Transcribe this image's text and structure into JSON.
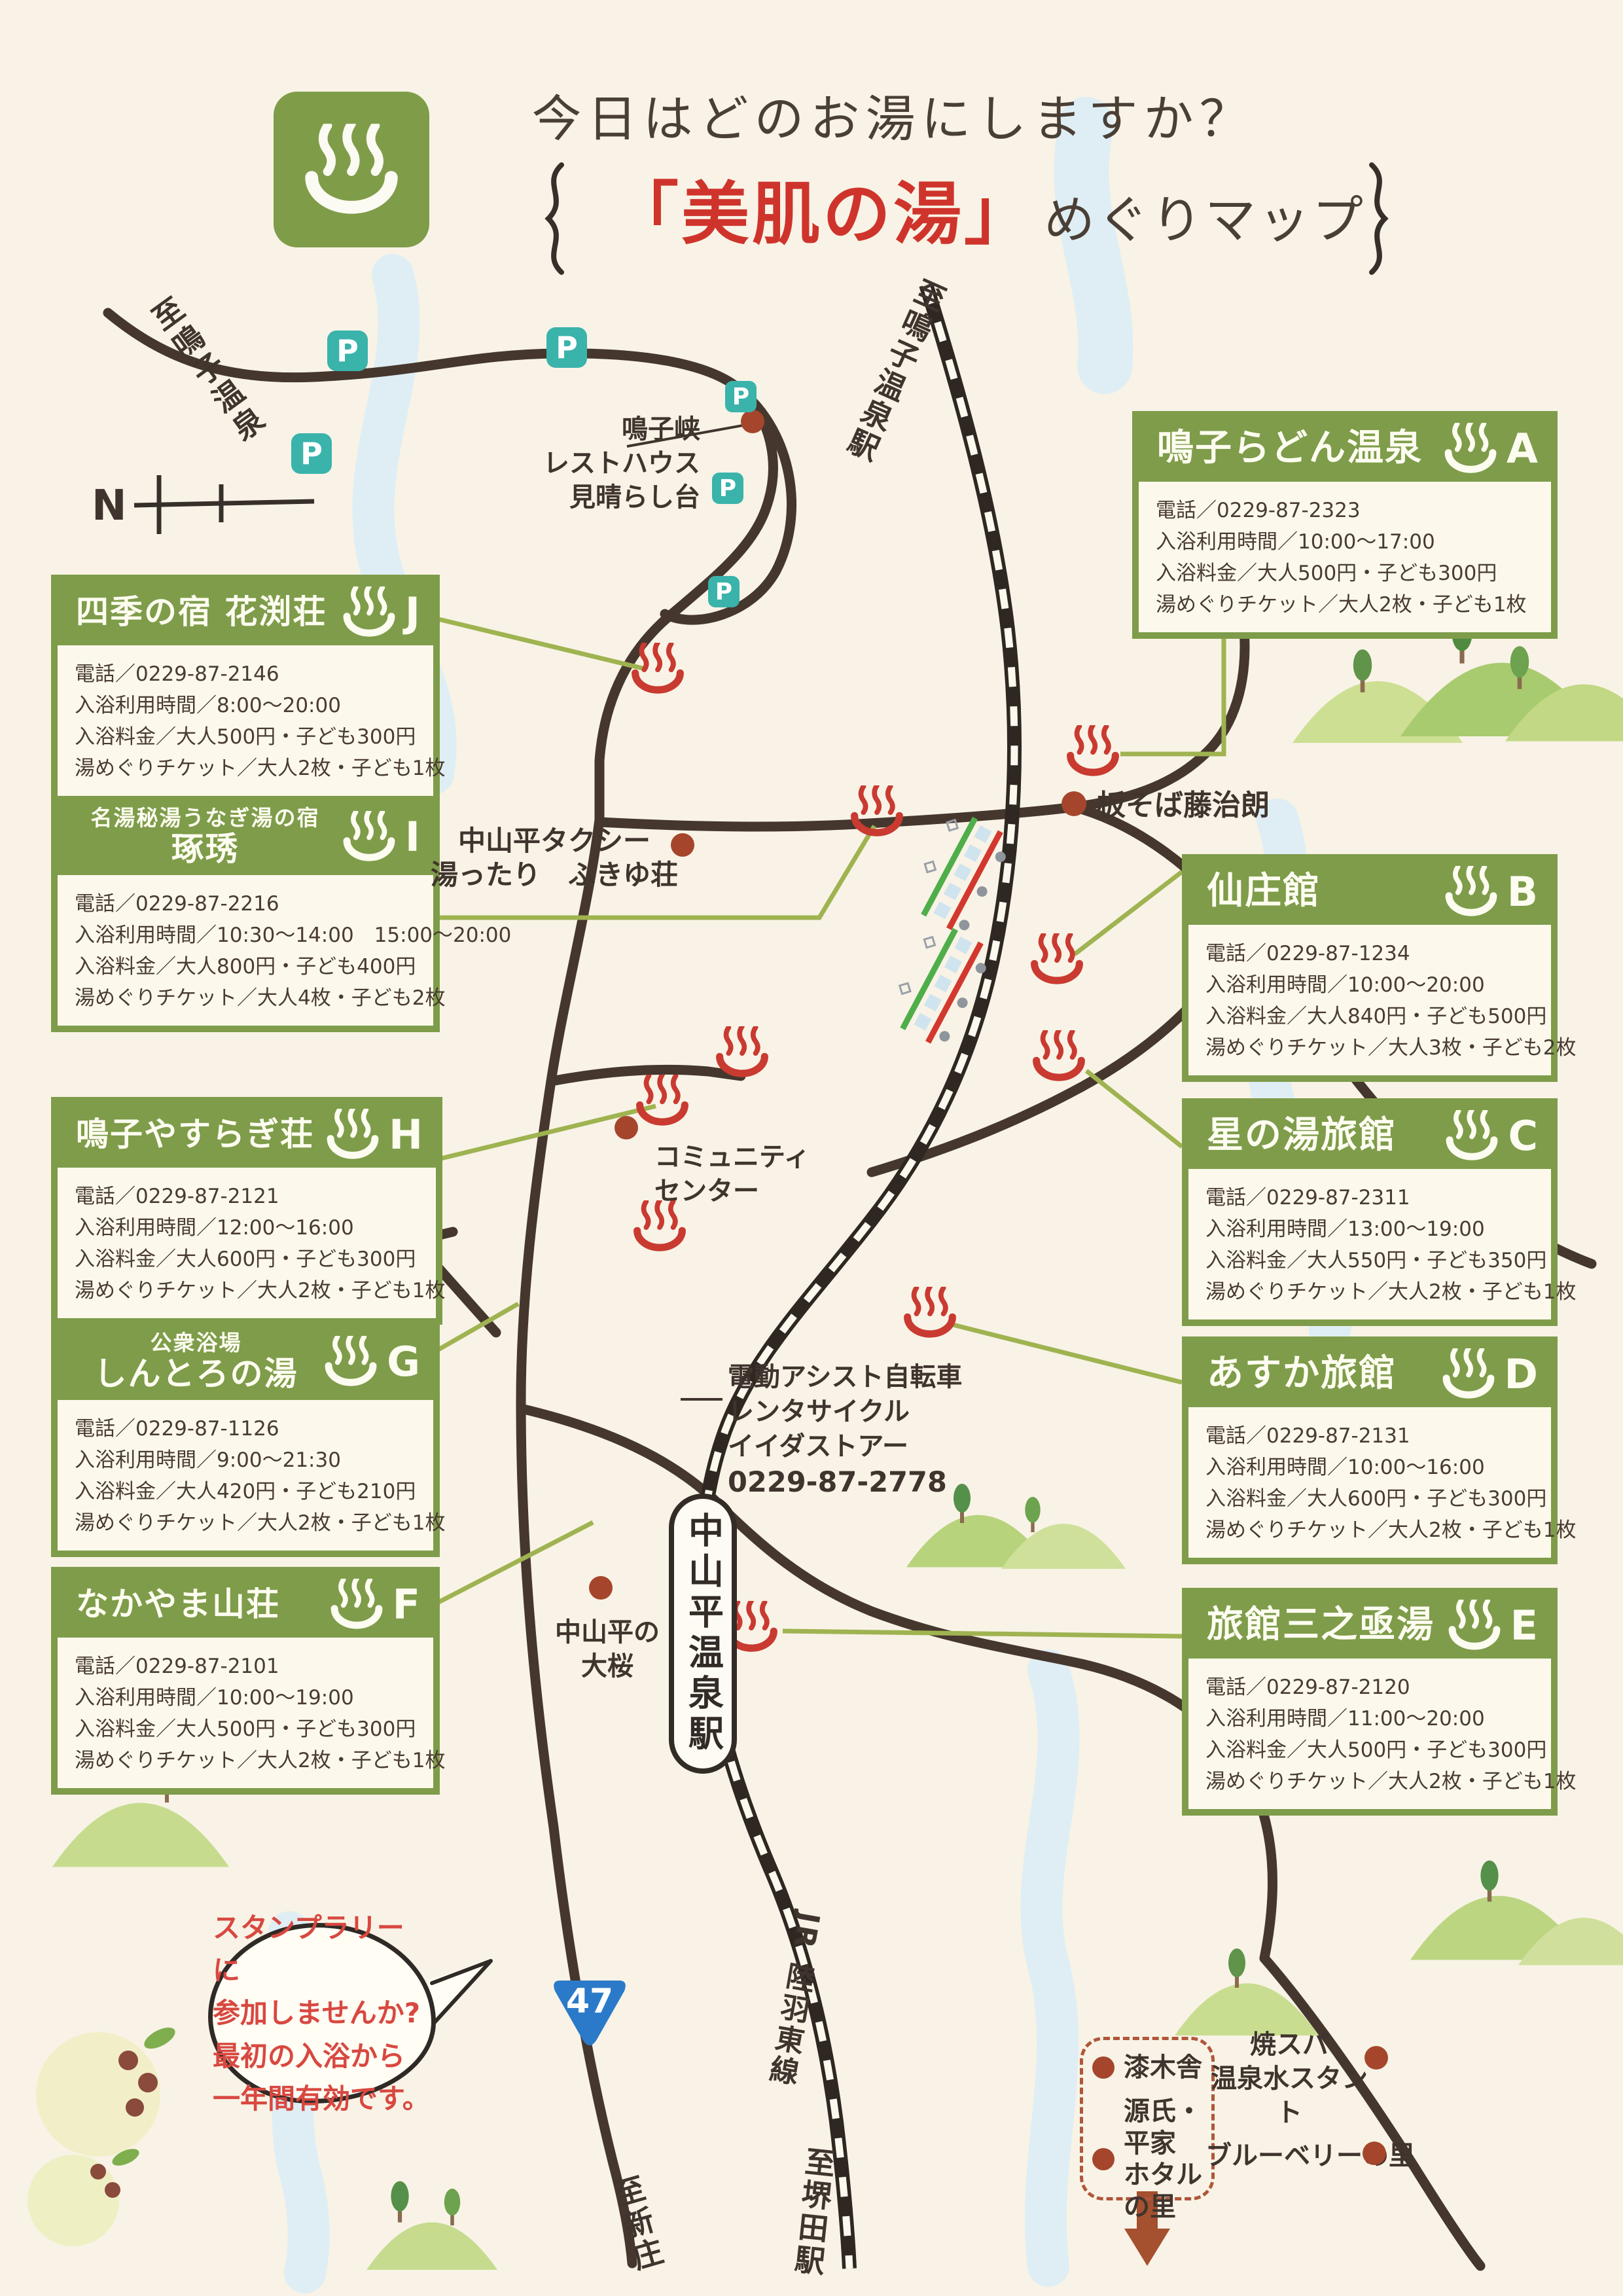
{
  "title": {
    "line1": "今日はどのお湯にしますか？",
    "line2_red": "「美肌の湯」",
    "line2_rest": "めぐりマップ"
  },
  "facilities": [
    {
      "letter": "A",
      "name": "鳴子らどん温泉",
      "phone": "電話／0229-87-2323",
      "hours": "入浴利用時間／10:00～17:00",
      "fee": "入浴料金／大人500円・子ども300円",
      "ticket": "湯めぐりチケット／大人2枚・子ども1枚"
    },
    {
      "letter": "B",
      "name": "仙庄館",
      "phone": "電話／0229-87-1234",
      "hours": "入浴利用時間／10:00～20:00",
      "fee": "入浴料金／大人840円・子ども500円",
      "ticket": "湯めぐりチケット／大人3枚・子ども2枚"
    },
    {
      "letter": "C",
      "name": "星の湯旅館",
      "phone": "電話／0229-87-2311",
      "hours": "入浴利用時間／13:00～19:00",
      "fee": "入浴料金／大人550円・子ども350円",
      "ticket": "湯めぐりチケット／大人2枚・子ども1枚"
    },
    {
      "letter": "D",
      "name": "あすか旅館",
      "phone": "電話／0229-87-2131",
      "hours": "入浴利用時間／10:00～16:00",
      "fee": "入浴料金／大人600円・子ども300円",
      "ticket": "湯めぐりチケット／大人2枚・子ども1枚"
    },
    {
      "letter": "E",
      "name": "旅館三之亟湯",
      "phone": "電話／0229-87-2120",
      "hours": "入浴利用時間／11:00～20:00",
      "fee": "入浴料金／大人500円・子ども300円",
      "ticket": "湯めぐりチケット／大人2枚・子ども1枚"
    },
    {
      "letter": "F",
      "name": "なかやま山荘",
      "phone": "電話／0229-87-2101",
      "hours": "入浴利用時間／10:00～19:00",
      "fee": "入浴料金／大人500円・子ども300円",
      "ticket": "湯めぐりチケット／大人2枚・子ども1枚"
    },
    {
      "letter": "G",
      "name_small": "公衆浴場",
      "name": "しんとろの湯",
      "phone": "電話／0229-87-1126",
      "hours": "入浴利用時間／9:00～21:30",
      "fee": "入浴料金／大人420円・子ども210円",
      "ticket": "湯めぐりチケット／大人2枚・子ども1枚"
    },
    {
      "letter": "H",
      "name": "鳴子やすらぎ荘",
      "phone": "電話／0229-87-2121",
      "hours": "入浴利用時間／12:00～16:00",
      "fee": "入浴料金／大人600円・子ども300円",
      "ticket": "湯めぐりチケット／大人2枚・子ども1枚"
    },
    {
      "letter": "I",
      "name_small": "名湯秘湯うなぎ湯の宿",
      "name": "琢琇",
      "phone": "電話／0229-87-2216",
      "hours": "入浴利用時間／10:30～14:00　15:00～20:00",
      "fee": "入浴料金／大人800円・子ども400円",
      "ticket": "湯めぐりチケット／大人4枚・子ども2枚"
    },
    {
      "letter": "J",
      "name": "四季の宿 花渕荘",
      "phone": "電話／0229-87-2146",
      "hours": "入浴利用時間／8:00～20:00",
      "fee": "入浴料金／大人500円・子ども300円",
      "ticket": "湯めぐりチケット／大人2枚・子ども1枚"
    }
  ],
  "map": {
    "labels": {
      "to_naruko_onsen": "至鳴子温泉",
      "to_naruko_onsen_sta": "至鳴子温泉駅",
      "resthouse": "鳴子峡\nレストハウス\n見晴らし台",
      "taxi": "中山平タクシー",
      "fukiyuso": "湯ったり　ふきゆ荘",
      "itasoba": "板そば藤治朗",
      "community": "コミュニティ\nセンター",
      "rental": "電動アシスト自転車\nレンタサイクル\nイイダストアー",
      "rental_phone": "0229-87-2778",
      "sakura": "中山平の\n大桜",
      "station": "中山平温泉駅",
      "jr_line": "JR 陸羽東線",
      "to_sakaida": "至堺田駅",
      "to_shinjo": "至新庄",
      "north": "N",
      "route47": "47",
      "parking": "P"
    },
    "legend": {
      "urushi": "漆木舎",
      "genji": "源氏・平家\nホタルの里",
      "yakispa": "焼スパ\n温泉水スタント",
      "blueberry": "ブルーベリーの里"
    },
    "bubble": "スタンプラリーに\n参加しませんか?\n最初の入浴から\n一年間有効です。"
  },
  "colors": {
    "box_green": "#7e9c4a",
    "onsen_red": "#c93a31",
    "parking_teal": "#3ab3ab",
    "poi_dot": "#a5462c",
    "route_blue": "#2b7ac9",
    "bubble_red": "#d84840"
  }
}
